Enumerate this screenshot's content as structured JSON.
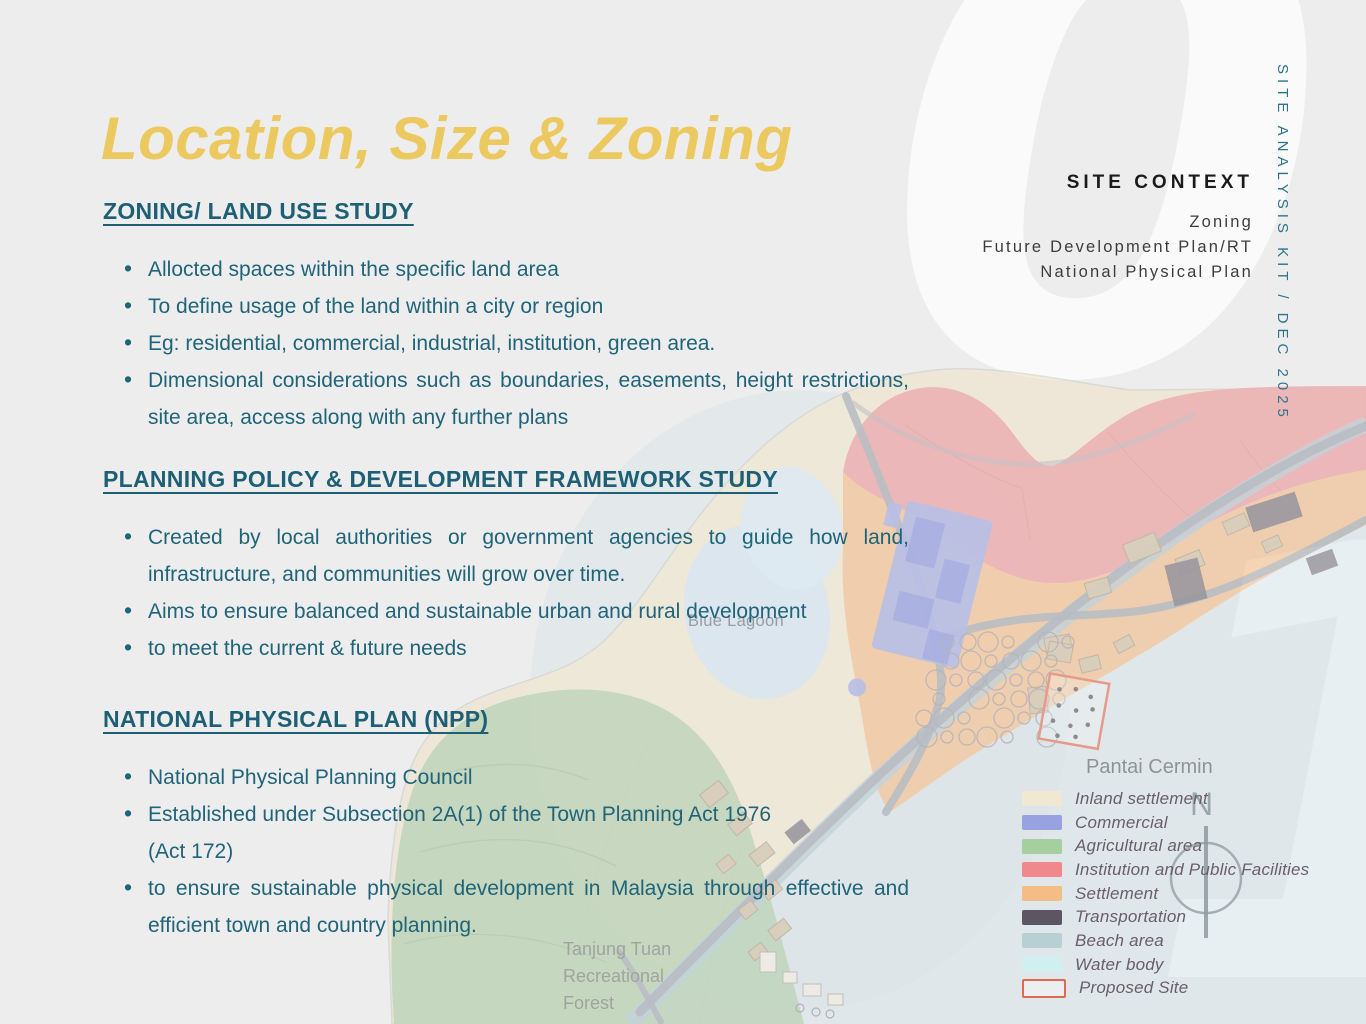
{
  "page": {
    "title": "Location, Size & Zoning",
    "background_color": "#ededee",
    "title_color": "#ecc95f",
    "heading_color": "#1d5f74",
    "body_color": "#1f6478"
  },
  "sections": [
    {
      "heading": "ZONING/ LAND USE STUDY",
      "bullets": [
        {
          "text": "Allocted spaces within the specific land area",
          "justified": false
        },
        {
          "text": "To define usage of the land within a city or region",
          "justified": false
        },
        {
          "text": "Eg: residential, commercial, industrial, institution, green area.",
          "justified": false
        },
        {
          "text": "Dimensional considerations such as boundaries, easements, height restrictions, site area, access along with any further plans",
          "justified": true
        }
      ]
    },
    {
      "heading": "PLANNING POLICY & DEVELOPMENT FRAMEWORK STUDY",
      "bullets": [
        {
          "text": "Created by local authorities or government agencies to guide how land, infrastructure, and communities will grow over time.",
          "justified": true
        },
        {
          "text": "Aims to ensure balanced and sustainable urban and rural development",
          "justified": false
        },
        {
          "text": "to meet the current & future needs",
          "justified": false
        }
      ]
    },
    {
      "heading": "NATIONAL PHYSICAL PLAN (NPP)",
      "bullets": [
        {
          "text": "National Physical Planning Council",
          "justified": false
        },
        {
          "text": "Established under Subsection 2A(1) of the Town Planning Act 1976\n(Act 172)",
          "justified": false
        },
        {
          "text": "to ensure sustainable physical development in Malaysia through effective and efficient town and country planning.",
          "justified": true
        }
      ]
    }
  ],
  "context_panel": {
    "heading": "SITE CONTEXT",
    "lines": [
      "Zoning",
      "Future Development Plan/RT",
      "National Physical Plan"
    ]
  },
  "side_tag": "SITE ANALYSIS KIT / DEC 2025",
  "watermark": {
    "digits": [
      "0",
      "1"
    ]
  },
  "map": {
    "labels": {
      "lagoon": "Blue Lagoon",
      "forest": "Tanjung Tuan\nRecreational\nForest",
      "legend_title": "Pantai Cermin",
      "compass": "N"
    },
    "legend": [
      {
        "label": "Inland settlement",
        "color": "#f1e8d4",
        "outline": ""
      },
      {
        "label": "Commercial",
        "color": "#98a2e0",
        "outline": ""
      },
      {
        "label": "Agricultural area",
        "color": "#a5cf9f",
        "outline": ""
      },
      {
        "label": "Institution and Public Facilities",
        "color": "#f0898c",
        "outline": ""
      },
      {
        "label": "Settlement",
        "color": "#f3bd85",
        "outline": ""
      },
      {
        "label": "Transportation",
        "color": "#5b5662",
        "outline": ""
      },
      {
        "label": "Beach area",
        "color": "#b8cfd4",
        "outline": ""
      },
      {
        "label": "Water body",
        "color": "#cfeff0",
        "outline": ""
      },
      {
        "label": "Proposed Site",
        "color": "rgba(255,255,255,0.35)",
        "outline": "#e2694b"
      }
    ]
  }
}
